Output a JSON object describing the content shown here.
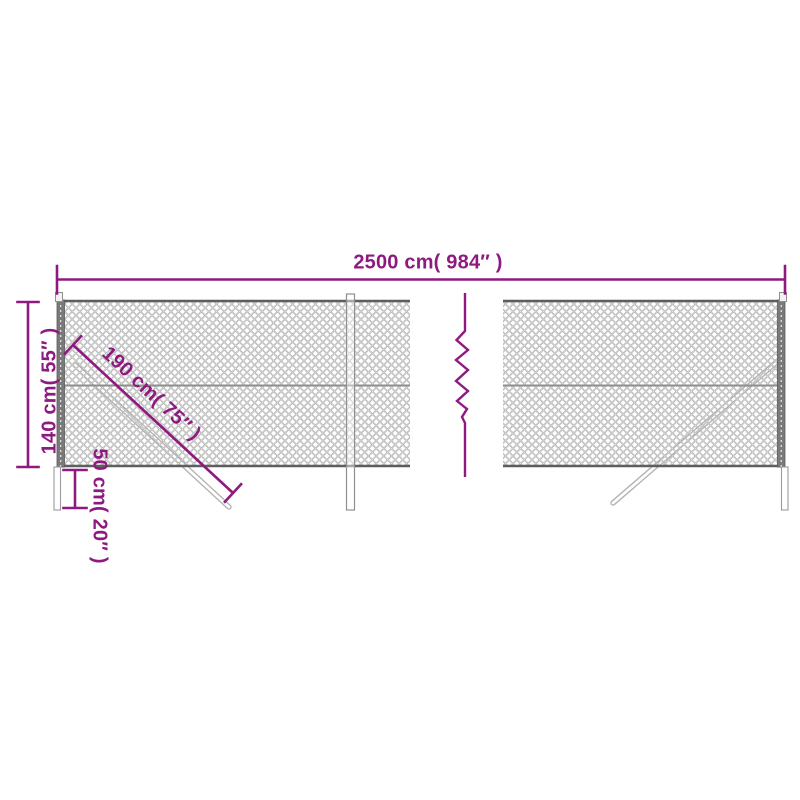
{
  "diagram": {
    "accent_color": "#8e1a80",
    "mesh_color": "#a0a0a0",
    "labels": {
      "total_width": "2500 cm( 984″ )",
      "height": "140 cm( 55″ )",
      "brace_length": "190 cm( 75″ )",
      "post_depth": "50 cm( 20″ )"
    }
  }
}
